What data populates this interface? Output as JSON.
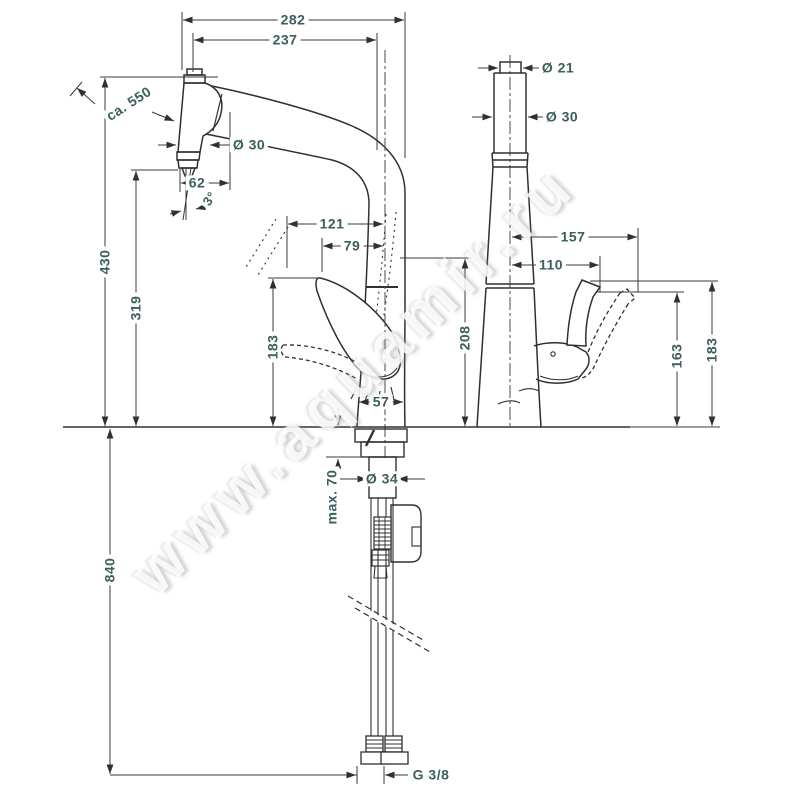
{
  "drawing": {
    "title": "kitchen mixer tap technical dimension drawing",
    "front_view": {
      "total_width": "282",
      "spout_reach": "237",
      "pullout_hose_length": "ca. 550",
      "spray_diameter": "Ø 30",
      "spray_offset": "62",
      "spray_angle": "3°",
      "total_height": "430",
      "outlet_height": "319",
      "handle_open_reach": "121",
      "handle_reach": "79",
      "handle_height": "183",
      "base_width": "57",
      "body_height": "208",
      "shank_diameter": "Ø 34",
      "max_counter_thickness": "max. 70",
      "hose_length_below": "840",
      "connection_thread": "G 3/8"
    },
    "side_view": {
      "top_diameter": "Ø 21",
      "body_diameter": "Ø 30",
      "handle_open_reach": "157",
      "handle_reach": "110",
      "handle_height": "163",
      "handle_open_height": "183"
    },
    "watermark": "www.aquamir.ru",
    "colors": {
      "dimension_text": "#3b5f5c",
      "outline": "#303030",
      "dimension_line": "#3a3a3a",
      "background": "#ffffff"
    }
  }
}
